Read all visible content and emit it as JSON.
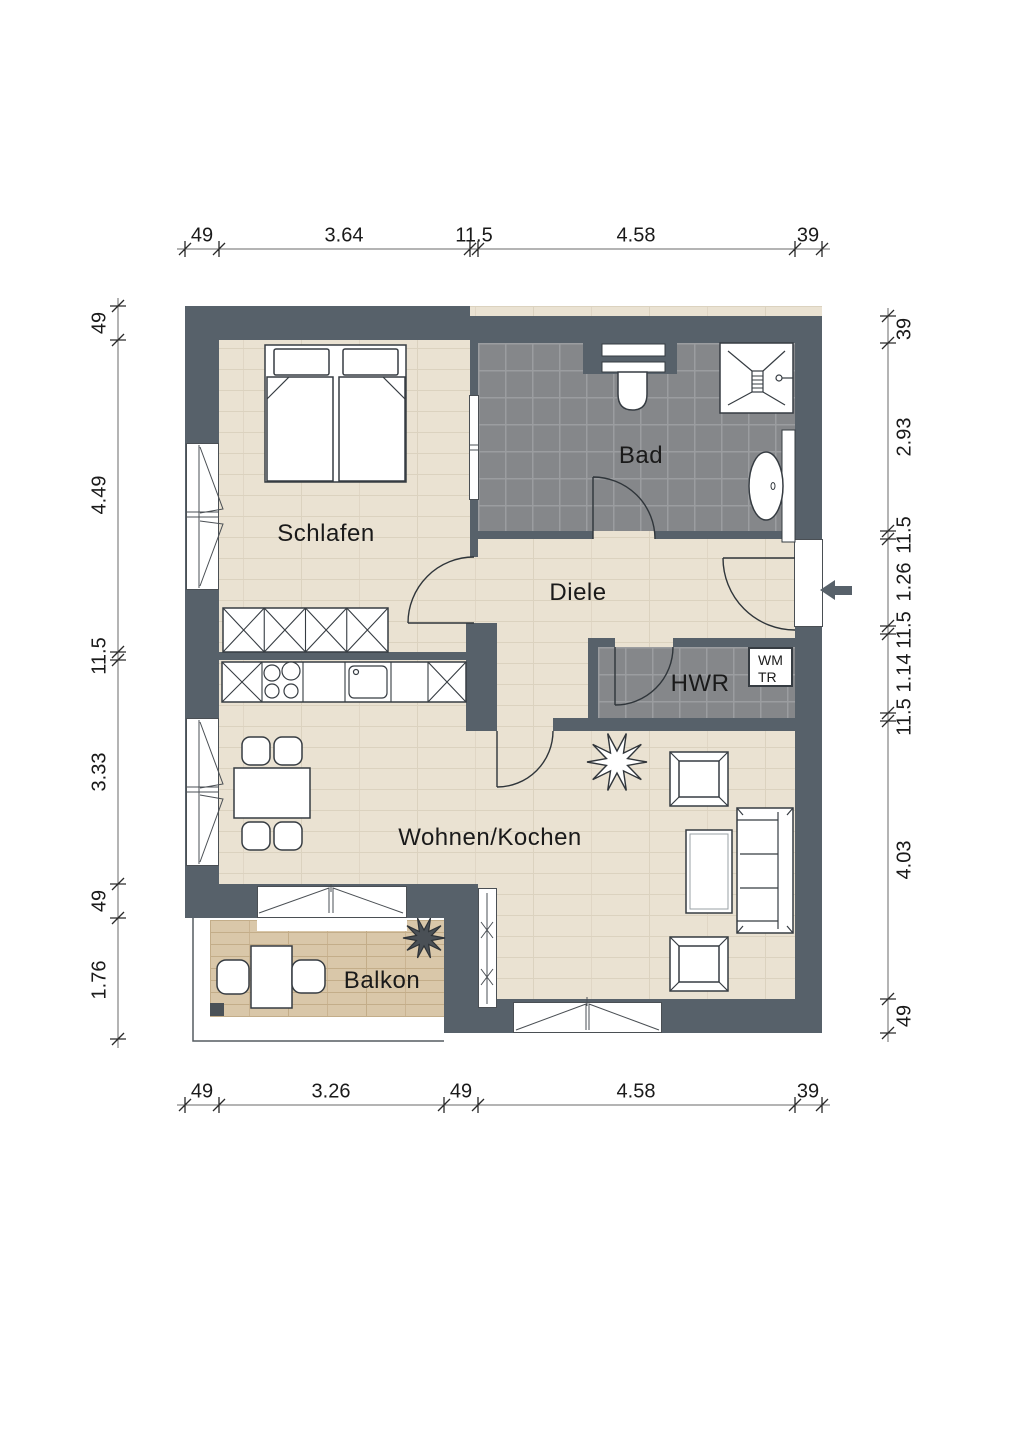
{
  "plan": {
    "rooms": [
      {
        "id": "schlafen",
        "label": "Schlafen"
      },
      {
        "id": "bad",
        "label": "Bad"
      },
      {
        "id": "diele",
        "label": "Diele"
      },
      {
        "id": "hwr",
        "label": "HWR"
      },
      {
        "id": "wohnen_kochen",
        "label": "Wohnen/Kochen"
      },
      {
        "id": "balkon",
        "label": "Balkon"
      }
    ],
    "appliance_labels": {
      "washing_machine": "WM",
      "dryer": "TR"
    }
  },
  "dimensions": {
    "top": [
      "49",
      "3.64",
      "11.5",
      "4.58",
      "39"
    ],
    "bottom": [
      "49",
      "3.26",
      "49",
      "4.58",
      "39"
    ],
    "left": [
      "49",
      "4.49",
      "11.5",
      "3.33",
      "49",
      "1.76"
    ],
    "right": [
      "39",
      "2.93",
      "11.5",
      "1.26",
      "11.5",
      "1.14",
      "11.5",
      "4.03",
      "49"
    ]
  },
  "icons": {
    "entry_arrow": "arrow pointing left into entrance door",
    "plant": "potted plant star silhouette",
    "shower": "shower tray with cross symbol"
  },
  "colors": {
    "wall": "#57616A",
    "bath_tile": "#85878A",
    "wood_floor": "#EAE2D2",
    "balcony_deck": "#D9C7A9",
    "outline": "#363C42"
  }
}
